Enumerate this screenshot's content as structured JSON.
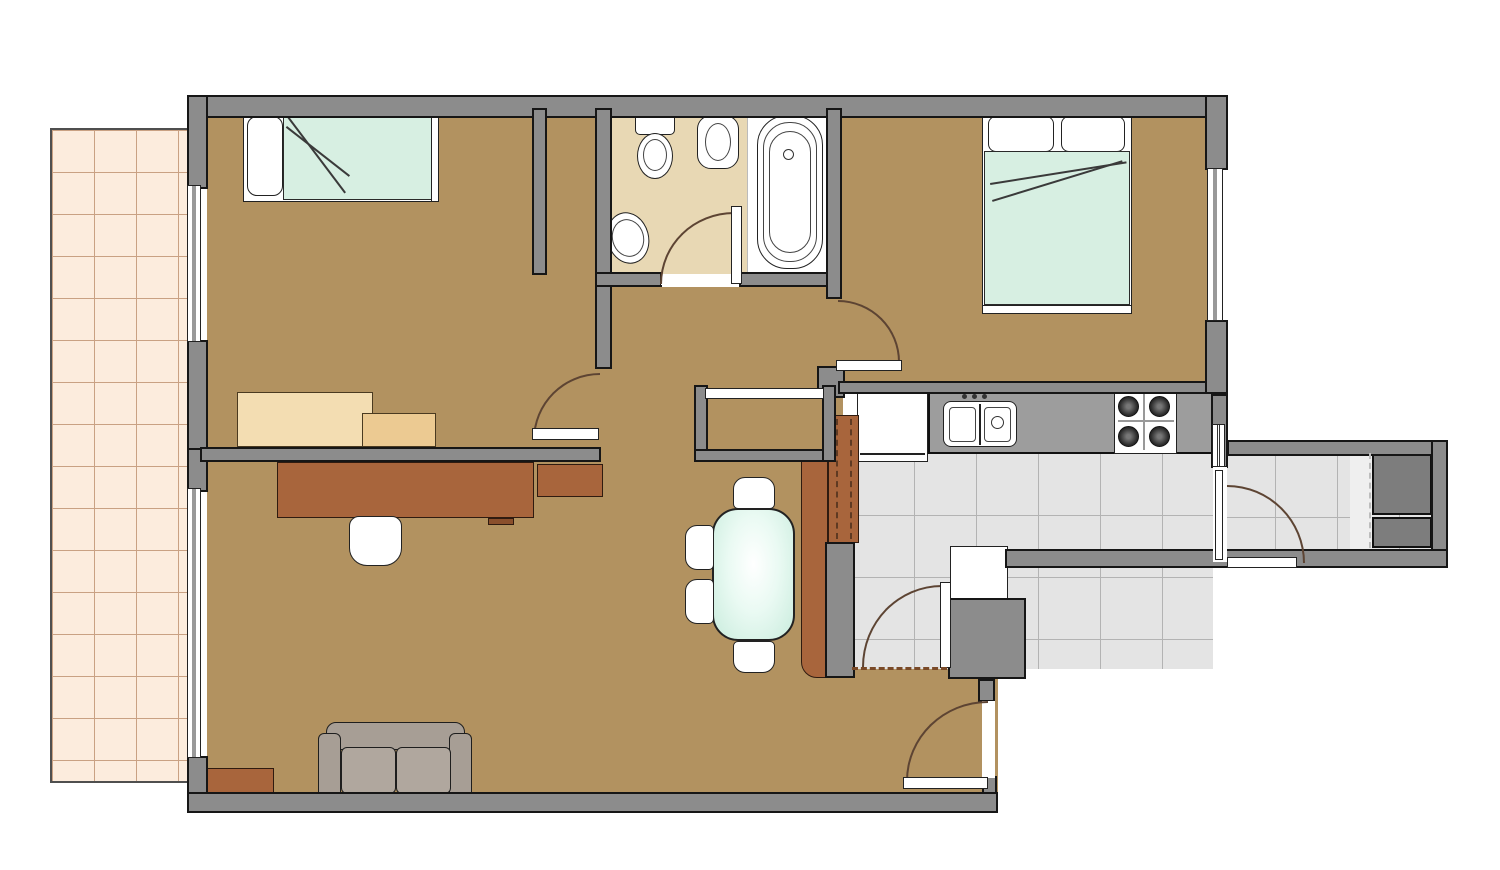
{
  "title": "apartment-floor-plan",
  "canvas": {
    "width": 1500,
    "height": 870
  },
  "colors": {
    "wall": "#8c8c8c",
    "floor": "#b29260",
    "bathroom_floor": "#e8d8b4",
    "kitchen_tiles": "#e4e4e4",
    "patio_tiles": "#fcecdd",
    "bedding_mint": "#d7efe2",
    "furniture_brown": "#a8653c",
    "sofa_gray": "#a79e95",
    "counter_gray": "#9d9d9d",
    "closet_dark": "#7d7d7d",
    "door_arc": "#5d4433"
  },
  "rooms": [
    "bedroom-1",
    "bathroom",
    "bedroom-2",
    "hall",
    "kitchen",
    "living-room",
    "utility-corridor",
    "patio"
  ],
  "elements": [
    {
      "n": "patio-terrace",
      "c": "patio",
      "x": 50,
      "y": 128,
      "w": 139,
      "h": 655
    },
    {
      "n": "floor-bedroom-1",
      "c": "floor-tan",
      "x": 207,
      "y": 117,
      "w": 392,
      "h": 330
    },
    {
      "n": "floor-hall",
      "c": "floor-tan",
      "x": 547,
      "y": 287,
      "w": 296,
      "h": 175
    },
    {
      "n": "floor-living-room",
      "c": "floor-tan",
      "x": 207,
      "y": 447,
      "w": 791,
      "h": 348
    },
    {
      "n": "floor-bedroom-2",
      "c": "floor-tan",
      "x": 842,
      "y": 117,
      "w": 365,
      "h": 267
    },
    {
      "n": "floor-bathroom",
      "c": "floor-bath",
      "x": 612,
      "y": 117,
      "w": 136,
      "h": 158
    },
    {
      "n": "floor-bathtub-area",
      "c": "floor-white",
      "x": 747,
      "y": 117,
      "w": 80,
      "h": 157
    },
    {
      "n": "floor-kitchen",
      "c": "tiles",
      "x": 852,
      "y": 453,
      "w": 361,
      "h": 216
    },
    {
      "n": "floor-corridor",
      "c": "tiles",
      "x": 1213,
      "y": 455,
      "w": 222,
      "h": 94
    },
    {
      "n": "corridor-threshold-strip",
      "c": "strip",
      "x": 1350,
      "y": 455,
      "w": 22,
      "h": 94
    },
    {
      "n": "bed-single-frame",
      "c": "white-box",
      "x": 243,
      "y": 110,
      "w": 196,
      "h": 92
    },
    {
      "n": "bed-single-pillow",
      "c": "pillow",
      "x": 247,
      "y": 116,
      "w": 36,
      "h": 80,
      "r": "10px"
    },
    {
      "n": "bed-single-blanket",
      "c": "mint",
      "x": 283,
      "y": 112,
      "w": 150,
      "h": 88
    },
    {
      "n": "bed-single-fold-line-a",
      "c": "fold",
      "x": 287,
      "y": 114,
      "w": 98,
      "h": 0,
      "rot": 53
    },
    {
      "n": "bed-single-fold-line-b",
      "c": "fold",
      "x": 287,
      "y": 126,
      "w": 80,
      "h": 0,
      "rot": 38
    },
    {
      "n": "bed-single-footboard",
      "c": "white-box",
      "x": 431,
      "y": 110,
      "w": 8,
      "h": 92
    },
    {
      "n": "desk-bedroom1-main",
      "c": "sand",
      "x": 237,
      "y": 392,
      "w": 136,
      "h": 55
    },
    {
      "n": "desk-bedroom1-side",
      "c": "sand-dark",
      "x": 362,
      "y": 413,
      "w": 74,
      "h": 34
    },
    {
      "n": "bed-double-frame",
      "c": "white-box",
      "x": 982,
      "y": 108,
      "w": 150,
      "h": 206
    },
    {
      "n": "bed-double-headboard",
      "c": "white-box",
      "x": 982,
      "y": 108,
      "w": 150,
      "h": 9
    },
    {
      "n": "bed-double-pillow-left",
      "c": "pillow",
      "x": 988,
      "y": 116,
      "w": 66,
      "h": 36,
      "r": "8px"
    },
    {
      "n": "bed-double-pillow-right",
      "c": "pillow",
      "x": 1061,
      "y": 116,
      "w": 64,
      "h": 36,
      "r": "8px"
    },
    {
      "n": "bed-double-blanket",
      "c": "mint",
      "x": 984,
      "y": 151,
      "w": 146,
      "h": 154
    },
    {
      "n": "bed-double-fold-line-a",
      "c": "fold",
      "x": 990,
      "y": 183,
      "w": 138,
      "h": 0,
      "rot": -9
    },
    {
      "n": "bed-double-fold-line-b",
      "c": "fold",
      "x": 992,
      "y": 200,
      "w": 136,
      "h": 0,
      "rot": -17
    },
    {
      "n": "bed-double-footboard",
      "c": "white-box",
      "x": 982,
      "y": 305,
      "w": 150,
      "h": 9
    },
    {
      "n": "desk-living-room",
      "c": "brown",
      "x": 277,
      "y": 462,
      "w": 257,
      "h": 56
    },
    {
      "n": "desk-living-extension",
      "c": "brown",
      "x": 537,
      "y": 464,
      "w": 66,
      "h": 33
    },
    {
      "n": "desk-keyboard-tab",
      "c": "brown-dark",
      "x": 488,
      "y": 518,
      "w": 26,
      "h": 7
    },
    {
      "n": "desk-chair",
      "c": "chair",
      "x": 349,
      "y": 516,
      "w": 53,
      "h": 50,
      "r": "10px 10px 18px 18px"
    },
    {
      "n": "sofa-back",
      "c": "sofa",
      "x": 326,
      "y": 722,
      "w": 139,
      "h": 28,
      "r": "10px 10px 4px 4px"
    },
    {
      "n": "sofa-arm-left",
      "c": "sofa",
      "x": 318,
      "y": 733,
      "w": 23,
      "h": 70,
      "r": "6px"
    },
    {
      "n": "sofa-arm-right",
      "c": "sofa",
      "x": 449,
      "y": 733,
      "w": 23,
      "h": 70,
      "r": "6px"
    },
    {
      "n": "sofa-cushion-left",
      "c": "sofa-light",
      "x": 341,
      "y": 747,
      "w": 55,
      "h": 47,
      "r": "6px"
    },
    {
      "n": "sofa-cushion-right",
      "c": "sofa-light",
      "x": 396,
      "y": 747,
      "w": 55,
      "h": 47,
      "r": "6px"
    },
    {
      "n": "sofa-base",
      "c": "sofa",
      "x": 331,
      "y": 793,
      "w": 130,
      "h": 12,
      "r": "3px"
    },
    {
      "n": "side-table",
      "c": "brown",
      "x": 207,
      "y": 768,
      "w": 67,
      "h": 32
    },
    {
      "n": "dining-table",
      "c": "mint-grad",
      "x": 712,
      "y": 508,
      "w": 83,
      "h": 133,
      "r": "26px"
    },
    {
      "n": "dining-chair-north",
      "c": "chair",
      "x": 733,
      "y": 477,
      "w": 42,
      "h": 32,
      "r": "12px 12px 5px 5px"
    },
    {
      "n": "dining-chair-west-1",
      "c": "chair",
      "x": 685,
      "y": 525,
      "w": 29,
      "h": 45,
      "r": "12px 5px 5px 12px"
    },
    {
      "n": "dining-chair-west-2",
      "c": "chair",
      "x": 685,
      "y": 579,
      "w": 29,
      "h": 45,
      "r": "12px 5px 5px 12px"
    },
    {
      "n": "dining-chair-south",
      "c": "chair",
      "x": 733,
      "y": 641,
      "w": 42,
      "h": 32,
      "r": "5px 5px 12px 12px"
    },
    {
      "n": "kitchen-counter",
      "c": "counter",
      "x": 928,
      "y": 392,
      "w": 285,
      "h": 62
    },
    {
      "n": "fridge",
      "c": "white-box",
      "x": 857,
      "y": 392,
      "w": 71,
      "h": 70
    },
    {
      "n": "fridge-door-line",
      "c": "line-dark",
      "x": 860,
      "y": 453,
      "w": 65,
      "h": 2
    },
    {
      "n": "pantry-cabinet",
      "c": "brown",
      "x": 828,
      "y": 415,
      "w": 31,
      "h": 128
    },
    {
      "n": "pantry-dash-1",
      "c": "dash-vb",
      "x": 836,
      "y": 419,
      "w": 1,
      "h": 120
    },
    {
      "n": "pantry-dash-2",
      "c": "dash-vb",
      "x": 850,
      "y": 419,
      "w": 1,
      "h": 120
    },
    {
      "n": "counter-peninsula",
      "c": "brown",
      "x": 801,
      "y": 460,
      "w": 27,
      "h": 218,
      "r": "0 0 0 16px"
    },
    {
      "n": "wall-kitchen-mid",
      "c": "wall",
      "x": 825,
      "y": 542,
      "w": 30,
      "h": 136
    },
    {
      "n": "kitchen-sink-unit",
      "c": "white-box",
      "x": 943,
      "y": 401,
      "w": 74,
      "h": 46,
      "r": "8px"
    },
    {
      "n": "kitchen-sink-divider",
      "c": "line-dark",
      "x": 979,
      "y": 404,
      "w": 2,
      "h": 41
    },
    {
      "n": "kitchen-basin-left",
      "c": "box-thin",
      "x": 949,
      "y": 407,
      "w": 27,
      "h": 35,
      "r": "4px"
    },
    {
      "n": "kitchen-basin-right",
      "c": "box-thin",
      "x": 984,
      "y": 407,
      "w": 27,
      "h": 35,
      "r": "4px"
    },
    {
      "n": "kitchen-basin-drain",
      "c": "circle-thin",
      "x": 991,
      "y": 416,
      "w": 13,
      "h": 13
    },
    {
      "n": "faucet-dot-1",
      "c": "dot",
      "x": 962,
      "y": 394,
      "w": 5,
      "h": 5
    },
    {
      "n": "faucet-dot-2",
      "c": "dot",
      "x": 972,
      "y": 394,
      "w": 5,
      "h": 5
    },
    {
      "n": "faucet-dot-3",
      "c": "dot",
      "x": 982,
      "y": 394,
      "w": 5,
      "h": 5
    },
    {
      "n": "stove",
      "c": "white-box",
      "x": 1114,
      "y": 390,
      "w": 63,
      "h": 64
    },
    {
      "n": "stove-bar-horizontal",
      "c": "line-gray",
      "x": 1118,
      "y": 420,
      "w": 56,
      "h": 2
    },
    {
      "n": "stove-bar-vertical",
      "c": "line-gray",
      "x": 1143,
      "y": 394,
      "w": 2,
      "h": 56
    },
    {
      "n": "stove-burner-1",
      "c": "burner",
      "x": 1118,
      "y": 396,
      "w": 21,
      "h": 21
    },
    {
      "n": "stove-burner-2",
      "c": "burner",
      "x": 1149,
      "y": 396,
      "w": 21,
      "h": 21
    },
    {
      "n": "stove-burner-3",
      "c": "burner",
      "x": 1118,
      "y": 426,
      "w": 21,
      "h": 21
    },
    {
      "n": "stove-burner-4",
      "c": "burner",
      "x": 1149,
      "y": 426,
      "w": 21,
      "h": 21
    },
    {
      "n": "kitchen-appliance",
      "c": "white-box",
      "x": 950,
      "y": 546,
      "w": 58,
      "h": 53
    },
    {
      "n": "corridor-cabinet-upper",
      "c": "dark-box",
      "x": 1372,
      "y": 452,
      "w": 60,
      "h": 63
    },
    {
      "n": "corridor-cabinet-lower",
      "c": "dark-box",
      "x": 1372,
      "y": 517,
      "w": 60,
      "h": 31
    },
    {
      "n": "toilet-tank",
      "c": "white-box",
      "x": 635,
      "y": 111,
      "w": 40,
      "h": 24,
      "r": "5px"
    },
    {
      "n": "toilet-bowl",
      "c": "oval",
      "x": 637,
      "y": 133,
      "w": 36,
      "h": 46
    },
    {
      "n": "toilet-bowl-inner",
      "c": "oval-thin",
      "x": 643,
      "y": 139,
      "w": 24,
      "h": 32
    },
    {
      "n": "bidet",
      "c": "white-box",
      "x": 697,
      "y": 115,
      "w": 42,
      "h": 54,
      "r": "14px"
    },
    {
      "n": "bidet-inner",
      "c": "oval-thin",
      "x": 705,
      "y": 123,
      "w": 26,
      "h": 38
    },
    {
      "n": "bathroom-sink",
      "c": "oval",
      "x": 607,
      "y": 212,
      "w": 42,
      "h": 52,
      "rot": -15
    },
    {
      "n": "bathroom-sink-inner",
      "c": "oval-thin",
      "x": 612,
      "y": 219,
      "w": 32,
      "h": 38,
      "rot": -15
    },
    {
      "n": "bathtub-outer",
      "c": "white-box",
      "x": 757,
      "y": 115,
      "w": 66,
      "h": 154,
      "r": "30px"
    },
    {
      "n": "bathtub-inner",
      "c": "box-thin",
      "x": 763,
      "y": 122,
      "w": 54,
      "h": 140,
      "r": "26px"
    },
    {
      "n": "bathtub-inner-2",
      "c": "box-thin",
      "x": 769,
      "y": 131,
      "w": 42,
      "h": 122,
      "r": "21px"
    },
    {
      "n": "bathtub-drain",
      "c": "circle-thin",
      "x": 783,
      "y": 149,
      "w": 11,
      "h": 11
    },
    {
      "n": "wall-top",
      "c": "wall",
      "x": 187,
      "y": 95,
      "w": 1041,
      "h": 23
    },
    {
      "n": "wall-left-upper",
      "c": "wall",
      "x": 187,
      "y": 95,
      "w": 21,
      "h": 94
    },
    {
      "n": "wall-left-mid",
      "c": "wall",
      "x": 187,
      "y": 340,
      "w": 21,
      "h": 110
    },
    {
      "n": "wall-left-living",
      "c": "wall",
      "x": 187,
      "y": 448,
      "w": 21,
      "h": 44
    },
    {
      "n": "wall-left-lower",
      "c": "wall",
      "x": 187,
      "y": 756,
      "w": 21,
      "h": 43
    },
    {
      "n": "wall-bottom",
      "c": "wall",
      "x": 187,
      "y": 792,
      "w": 811,
      "h": 21
    },
    {
      "n": "wall-bedroom1-right",
      "c": "wall",
      "x": 532,
      "y": 108,
      "w": 15,
      "h": 167
    },
    {
      "n": "wall-bathroom-left",
      "c": "wall",
      "x": 595,
      "y": 108,
      "w": 17,
      "h": 261
    },
    {
      "n": "wall-bathroom-bottom-left",
      "c": "wall",
      "x": 595,
      "y": 272,
      "w": 67,
      "h": 15
    },
    {
      "n": "wall-bathroom-bottom-right",
      "c": "wall",
      "x": 739,
      "y": 272,
      "w": 100,
      "h": 15
    },
    {
      "n": "wall-bedroom2-left",
      "c": "wall",
      "x": 826,
      "y": 108,
      "w": 16,
      "h": 191
    },
    {
      "n": "wall-junction-bedroom2",
      "c": "wall",
      "x": 817,
      "y": 366,
      "w": 28,
      "h": 32
    },
    {
      "n": "wall-kitchen-top",
      "c": "wall",
      "x": 838,
      "y": 381,
      "w": 390,
      "h": 13
    },
    {
      "n": "wall-bedroom2-right-upper",
      "c": "wall",
      "x": 1205,
      "y": 95,
      "w": 23,
      "h": 75
    },
    {
      "n": "wall-bedroom2-right-lower",
      "c": "wall",
      "x": 1205,
      "y": 320,
      "w": 23,
      "h": 74
    },
    {
      "n": "wall-kitchen-right",
      "c": "wall",
      "x": 1211,
      "y": 394,
      "w": 17,
      "h": 74
    },
    {
      "n": "wall-corridor-top",
      "c": "wall",
      "x": 1227,
      "y": 440,
      "w": 221,
      "h": 16
    },
    {
      "n": "wall-corridor-right",
      "c": "wall",
      "x": 1431,
      "y": 440,
      "w": 17,
      "h": 128
    },
    {
      "n": "wall-corridor-bottom",
      "c": "wall",
      "x": 1005,
      "y": 549,
      "w": 443,
      "h": 19
    },
    {
      "n": "wall-kitchen-block",
      "c": "wall",
      "x": 948,
      "y": 598,
      "w": 78,
      "h": 81
    },
    {
      "n": "wall-entry-stub",
      "c": "wall",
      "x": 978,
      "y": 679,
      "w": 17,
      "h": 23
    },
    {
      "n": "wall-entry-lower",
      "c": "wall",
      "x": 982,
      "y": 776,
      "w": 15,
      "h": 18
    },
    {
      "n": "closet-wall-left",
      "c": "wall",
      "x": 694,
      "y": 385,
      "w": 14,
      "h": 77
    },
    {
      "n": "closet-wall-bottom",
      "c": "wall",
      "x": 694,
      "y": 449,
      "w": 142,
      "h": 13
    },
    {
      "n": "closet-wall-right",
      "c": "wall",
      "x": 822,
      "y": 385,
      "w": 14,
      "h": 77
    },
    {
      "n": "wall-living-top",
      "c": "wall",
      "x": 200,
      "y": 447,
      "w": 401,
      "h": 15
    },
    {
      "n": "window-bedroom1",
      "c": "window-v",
      "x": 187,
      "y": 185,
      "w": 14,
      "h": 157
    },
    {
      "n": "window-living-room",
      "c": "window-v",
      "x": 187,
      "y": 488,
      "w": 14,
      "h": 270
    },
    {
      "n": "window-bedroom2",
      "c": "window-v",
      "x": 1207,
      "y": 168,
      "w": 16,
      "h": 153
    },
    {
      "n": "window-kitchen",
      "c": "window-v",
      "x": 1212,
      "y": 424,
      "w": 13,
      "h": 43
    },
    {
      "n": "closet-sliding-door",
      "c": "leaf",
      "x": 705,
      "y": 388,
      "w": 119,
      "h": 11
    },
    {
      "n": "bathroom-door-gap",
      "c": "gap",
      "x": 661,
      "y": 274,
      "w": 78,
      "h": 11
    },
    {
      "n": "bathroom-door-arc",
      "c": "arc-tl",
      "x": 660,
      "y": 212,
      "w": 74,
      "h": 72
    },
    {
      "n": "bathroom-door-leaf",
      "c": "leaf",
      "x": 731,
      "y": 206,
      "w": 11,
      "h": 78
    },
    {
      "n": "bedroom2-door-arc",
      "c": "arc-tr",
      "x": 838,
      "y": 300,
      "w": 62,
      "h": 62
    },
    {
      "n": "bedroom2-door-leaf",
      "c": "leaf",
      "x": 836,
      "y": 360,
      "w": 66,
      "h": 11
    },
    {
      "n": "hall-door-arc",
      "c": "arc-tl",
      "x": 533,
      "y": 373,
      "w": 67,
      "h": 67
    },
    {
      "n": "hall-door-leaf",
      "c": "leaf",
      "x": 532,
      "y": 428,
      "w": 67,
      "h": 12
    },
    {
      "n": "kitchen-door-arc",
      "c": "arc-tl",
      "x": 862,
      "y": 585,
      "w": 80,
      "h": 82
    },
    {
      "n": "kitchen-door-leaf",
      "c": "leaf",
      "x": 940,
      "y": 582,
      "w": 11,
      "h": 86
    },
    {
      "n": "corridor-door-gap",
      "c": "gap",
      "x": 1213,
      "y": 467,
      "w": 14,
      "h": 95
    },
    {
      "n": "corridor-door-closed-leaf",
      "c": "leaf",
      "x": 1215,
      "y": 470,
      "w": 8,
      "h": 90
    },
    {
      "n": "corridor-door-arc",
      "c": "arc-tr",
      "x": 1227,
      "y": 485,
      "w": 78,
      "h": 78
    },
    {
      "n": "corridor-door-leaf",
      "c": "leaf",
      "x": 1227,
      "y": 557,
      "w": 70,
      "h": 11
    },
    {
      "n": "entry-door-gap",
      "c": "gap",
      "x": 982,
      "y": 701,
      "w": 13,
      "h": 77
    },
    {
      "n": "entry-door-arc",
      "c": "arc-tl",
      "x": 906,
      "y": 701,
      "w": 82,
      "h": 80
    },
    {
      "n": "entry-door-leaf",
      "c": "leaf",
      "x": 903,
      "y": 777,
      "w": 85,
      "h": 12
    },
    {
      "n": "threshold-kitchen-living",
      "c": "dash-h",
      "x": 852,
      "y": 667,
      "w": 95,
      "h": 3
    },
    {
      "n": "threshold-corridor",
      "c": "dash-v",
      "x": 1369,
      "y": 453,
      "w": 2,
      "h": 95
    }
  ]
}
